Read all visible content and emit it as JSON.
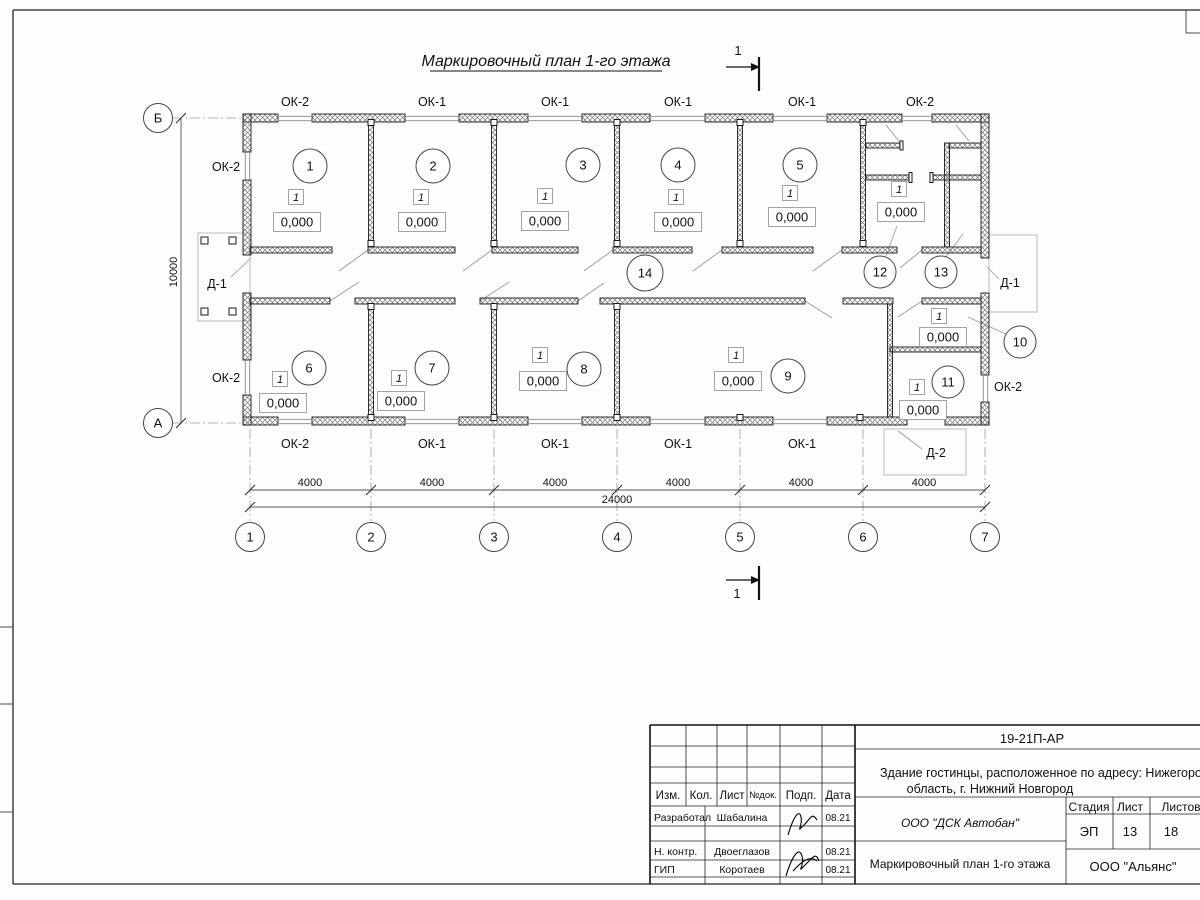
{
  "plan": {
    "title": "Маркировочный план 1-го этажа",
    "section_label": "1",
    "top_windows": [
      "ОК-2",
      "ОК-1",
      "ОК-1",
      "ОК-1",
      "ОК-1",
      "ОК-2"
    ],
    "bottom_windows": [
      "ОК-2",
      "ОК-1",
      "ОК-1",
      "ОК-1",
      "ОК-1"
    ],
    "left_windows": [
      "ОК-2",
      "ОК-2"
    ],
    "right_window": "ОК-2",
    "doors": {
      "west": "Д-1",
      "east": "Д-1",
      "south": "Д-2"
    },
    "rooms": [
      "1",
      "2",
      "3",
      "4",
      "5",
      "6",
      "7",
      "8",
      "9",
      "10",
      "11",
      "12",
      "13",
      "14"
    ],
    "mark": {
      "type": "1",
      "elevation": "0,000"
    },
    "axes_x": [
      "1",
      "2",
      "3",
      "4",
      "5",
      "6",
      "7"
    ],
    "axes_y": {
      "top": "Б",
      "bottom": "А"
    },
    "dims": {
      "bay": "4000",
      "total": "24000",
      "depth": "10000"
    }
  },
  "title_block": {
    "code": "19-21П-АР",
    "project_line1": "Здание гостинцы, расположенное по адресу: Нижегородская",
    "project_line2": "область, г. Нижний Новгород",
    "header": [
      "Изм.",
      "Кол.",
      "Лист",
      "№док.",
      "Подп.",
      "Дата"
    ],
    "rows": [
      {
        "role": "Разработал",
        "name": "Шабалина",
        "date": "08.21"
      },
      {
        "role": "Н. контр.",
        "name": "Двоеглазов",
        "date": "08.21"
      },
      {
        "role": "ГИП",
        "name": "Коротаев",
        "date": "08.21"
      }
    ],
    "org": "ООО \"ДСК Автобан\"",
    "drawing_title": "Маркировочный план 1-го этажа",
    "stage_header": [
      "Стадия",
      "Лист",
      "Листов"
    ],
    "stage": "ЭП",
    "sheet": "13",
    "sheets": "18",
    "contractor": "ООО \"Альянс\""
  }
}
